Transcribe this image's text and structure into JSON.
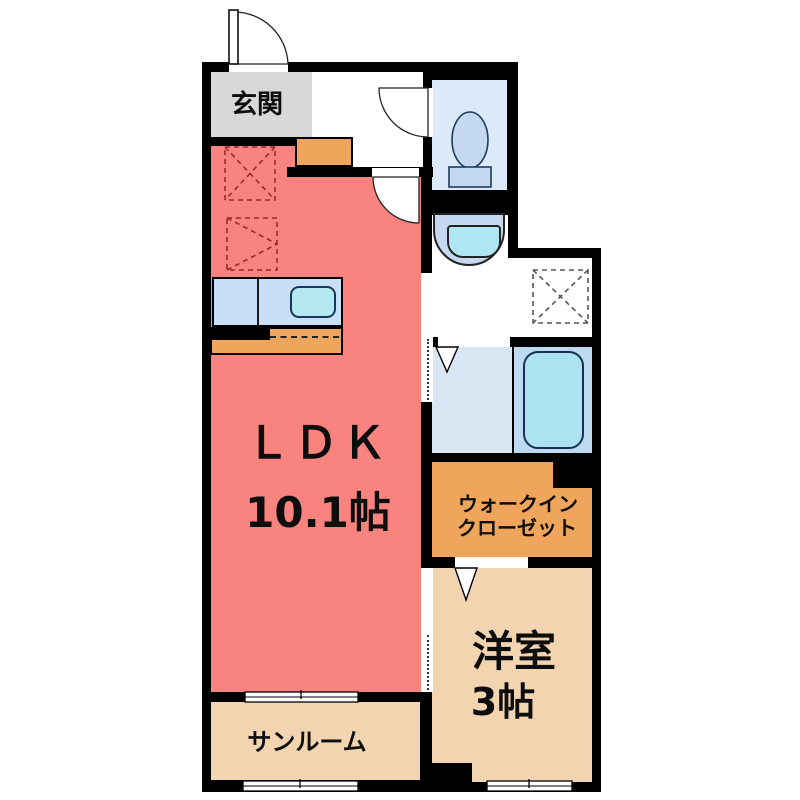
{
  "plan_type": "japanese-apartment-floorplan",
  "rooms": {
    "entrance": {
      "label": "玄関"
    },
    "ldk": {
      "label": "ＬＤＫ",
      "size": "10.1帖"
    },
    "walk_in_closet": {
      "label_line1": "ウォークイン",
      "label_line2": "クローゼット"
    },
    "western_room": {
      "label": "洋室",
      "size": "3帖"
    },
    "sunroom": {
      "label": "サンルーム"
    }
  },
  "fixtures": [
    "entrance-door",
    "hall-door",
    "toilet-door",
    "toilet",
    "washbasin",
    "washing-machine-space",
    "refrigerator-space",
    "shelf-space",
    "kitchen-counter",
    "kitchen-sink",
    "lower-counter",
    "bathtub",
    "bath-folding-door",
    "closet-folding-door",
    "sliding-doors",
    "windows"
  ],
  "colors": {
    "wall": "#000000",
    "ldk_floor": "#f9837f",
    "entrance_floor": "#d8d8d8",
    "tan_floor": "#f3d4b0",
    "closet_floor": "#f0a55c",
    "wet_room_floor": "#dce9f8",
    "tub_area_floor": "#bed9f2",
    "fixture_blue": "#c4d8f0",
    "water_cyan": "#aee6f2",
    "counter_blue": "#c9dff7"
  }
}
